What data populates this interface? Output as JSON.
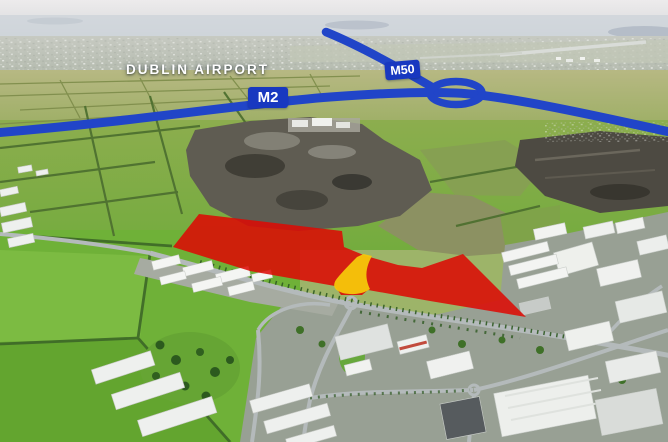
{
  "labels": {
    "airport": "DUBLIN AIRPORT",
    "m2": "M2",
    "m50": "M50"
  },
  "overlay": {
    "route_color": "#2145c8",
    "badge_bg": "#1838c0",
    "badge_text_color": "#ffffff",
    "site_fill": "#dd0a05",
    "site_opacity": "0.87",
    "access_fill": "#f6c70b",
    "label_color": "#ffffff"
  }
}
